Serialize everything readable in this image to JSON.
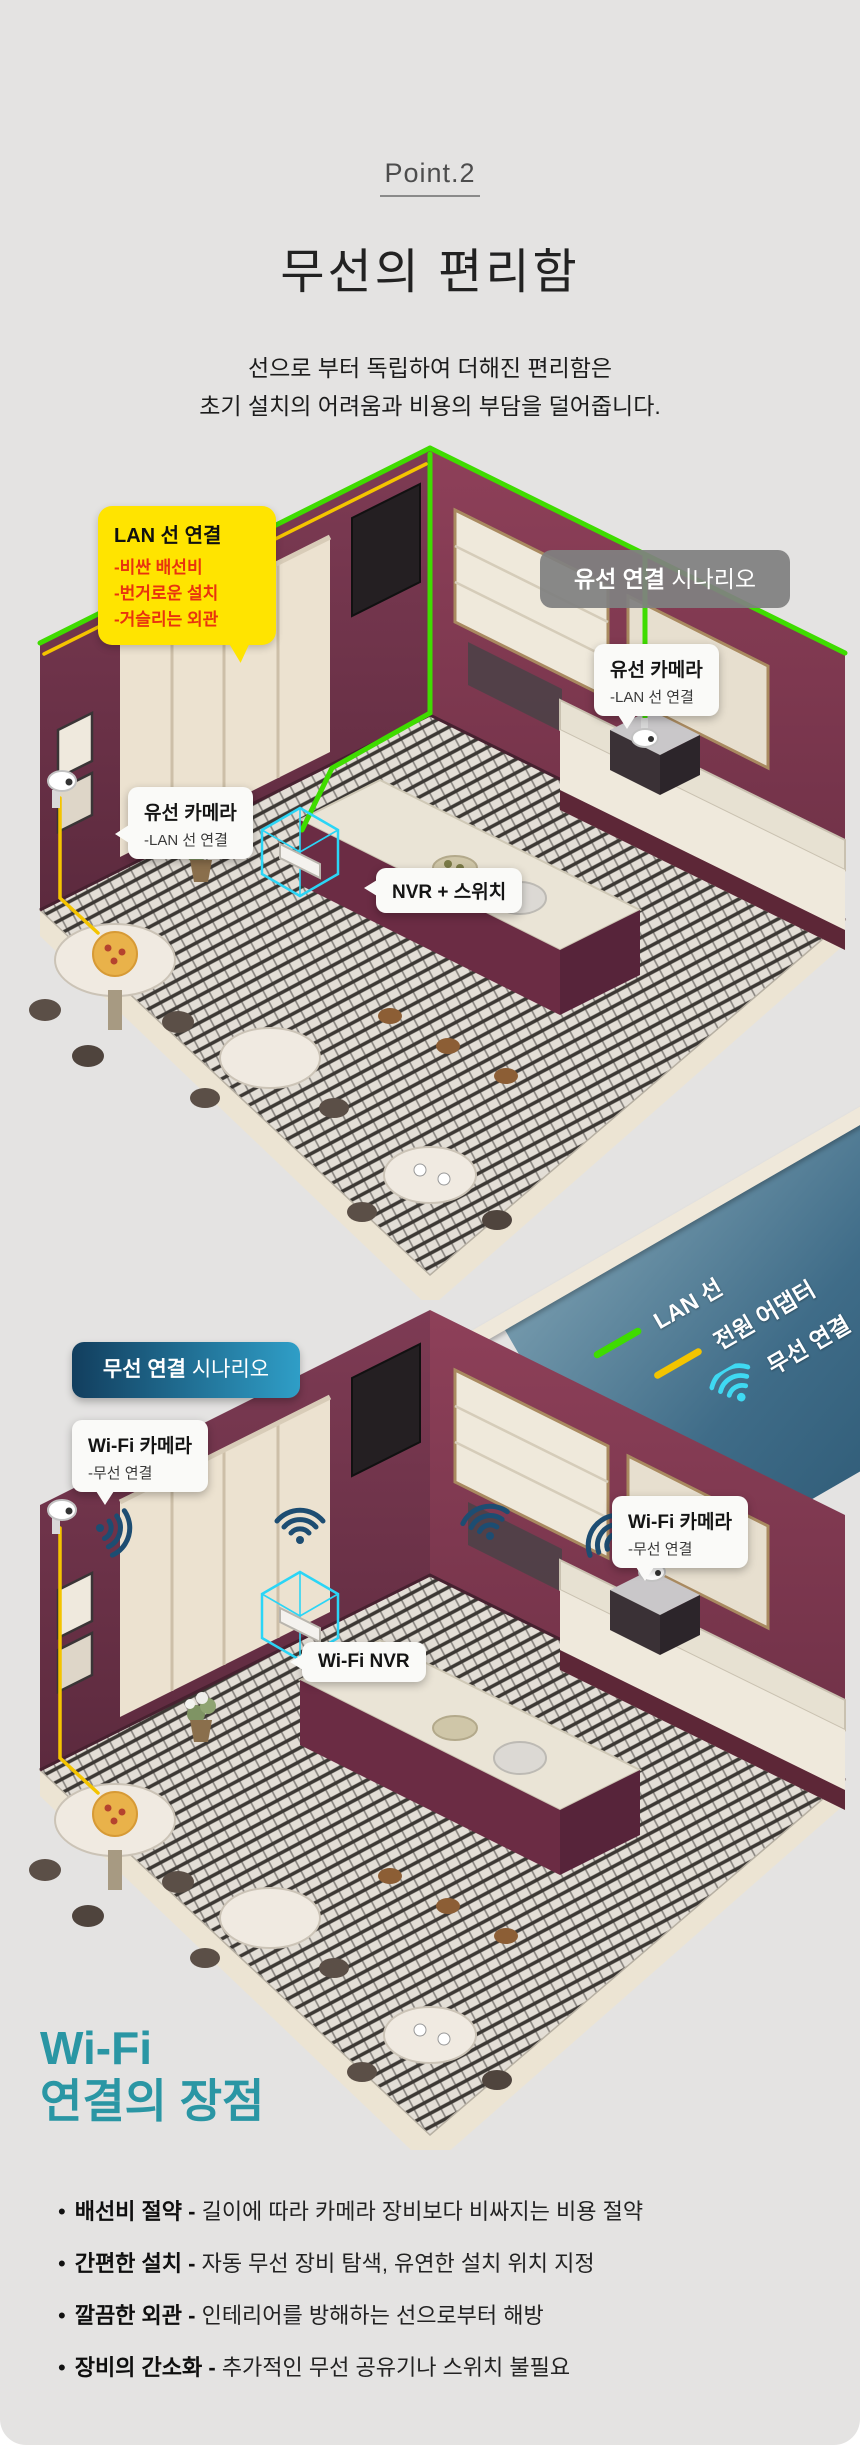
{
  "page": {
    "kicker": "Point.2",
    "title": "무선의 편리함",
    "subtitle_line1": "선으로 부터 독립하여 더해진 편리함은",
    "subtitle_line2": "초기 설치의 어려움과 비용의 부담을 덜어줍니다."
  },
  "wired_scene": {
    "badge_bold": "유선 연결",
    "badge_rest": " 시나리오",
    "warning_bubble": {
      "title": "LAN 선 연결",
      "items": [
        "-비싼 배선비",
        "-번거로운 설치",
        "-거슬리는 외관"
      ]
    },
    "camera_label_left": {
      "title": "유선 카메라",
      "sub": "-LAN 선 연결"
    },
    "camera_label_right": {
      "title": "유선 카메라",
      "sub": "-LAN 선 연결"
    },
    "nvr_label": "NVR + 스위치"
  },
  "legend": {
    "items": [
      {
        "icon": "lan-line",
        "label": "LAN 선",
        "color": "#3fdc00"
      },
      {
        "icon": "power-line",
        "label": "전원 어댑터",
        "color": "#f4c400"
      },
      {
        "icon": "wifi",
        "label": "무선 연결",
        "color": "#3fd9f2"
      }
    ]
  },
  "wireless_scene": {
    "badge_bold": "무선 연결",
    "badge_rest": " 시나리오",
    "camera_label_left": {
      "title": "Wi-Fi 카메라",
      "sub": "-무선 연결"
    },
    "camera_label_right": {
      "title": "Wi-Fi 카메라",
      "sub": "-무선 연결"
    },
    "nvr_label": "Wi-Fi NVR"
  },
  "benefits": {
    "heading_line1": "Wi-Fi",
    "heading_line2": "연결의 장점",
    "items": [
      {
        "bold": "배선비 절약 - ",
        "text": "길이에 따라 카메라 장비보다 비싸지는 비용 절약"
      },
      {
        "bold": "간편한 설치 - ",
        "text": "자동 무선 장비 탐색, 유연한 설치 위치 지정"
      },
      {
        "bold": "깔끔한 외관 - ",
        "text": "인테리어를 방해하는 선으로부터 해방"
      },
      {
        "bold": "장비의 간소화 - ",
        "text": "추가적인 무선 공유기나 스위치 불필요"
      }
    ]
  },
  "colors": {
    "background": "#e4e3e2",
    "accent_teal": "#2a96a4",
    "bubble_yellow": "#ffe400",
    "bubble_red_text": "#e8330e",
    "wired_badge_gray": "#808080",
    "wireless_badge_gradient": [
      "#123e5e",
      "#2f9ec7"
    ],
    "lan_green": "#3fdc00",
    "power_yellow": "#f4c400",
    "legend_wifi_cyan": "#3fd9f2",
    "scene_wifi_navy": "#1d4d72",
    "nvr_highlight_cyan": "#2bd5f6",
    "wall_maroon": "#7e3b54"
  }
}
